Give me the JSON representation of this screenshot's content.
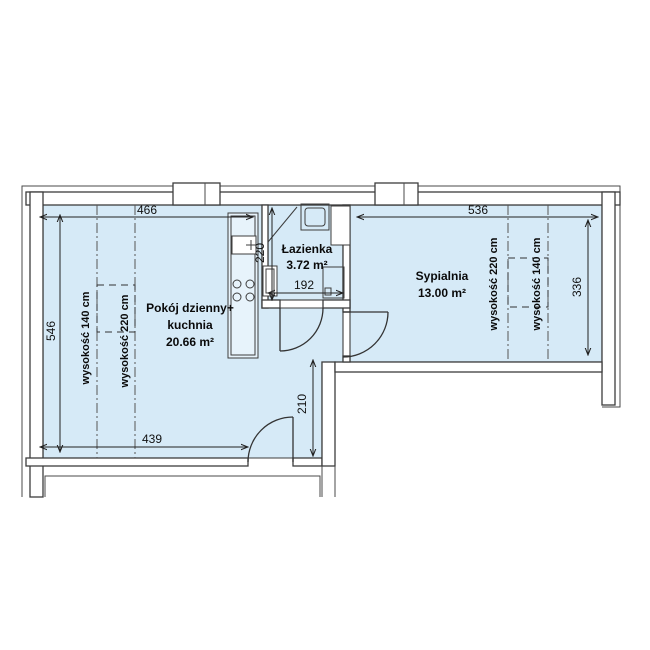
{
  "rooms": {
    "living": {
      "line1": "Pokój dzienny+",
      "line2": "kuchnia",
      "area": "20.66 m²"
    },
    "bathroom": {
      "name": "Łazienka",
      "area": "3.72 m²"
    },
    "bedroom": {
      "name": "Sypialnia",
      "area": "13.00 m²"
    }
  },
  "dimensions": {
    "living_width": "466",
    "bedroom_width": "536",
    "living_height": "546",
    "bedroom_height": "336",
    "living_bottom_width": "439",
    "hall_height": "210",
    "bathroom_width": "192",
    "bathroom_depth": "220"
  },
  "ceiling_heights": {
    "living_low": "wysokość 140 cm",
    "living_high": "wysokość 220 cm",
    "bedroom_high": "wysokość 220 cm",
    "bedroom_low": "wysokość 140 cm"
  },
  "colors": {
    "floor": "#d6eaf7",
    "counter": "#e7f3fb",
    "wall_outline": "#3d3d3d",
    "background": "#ffffff"
  }
}
